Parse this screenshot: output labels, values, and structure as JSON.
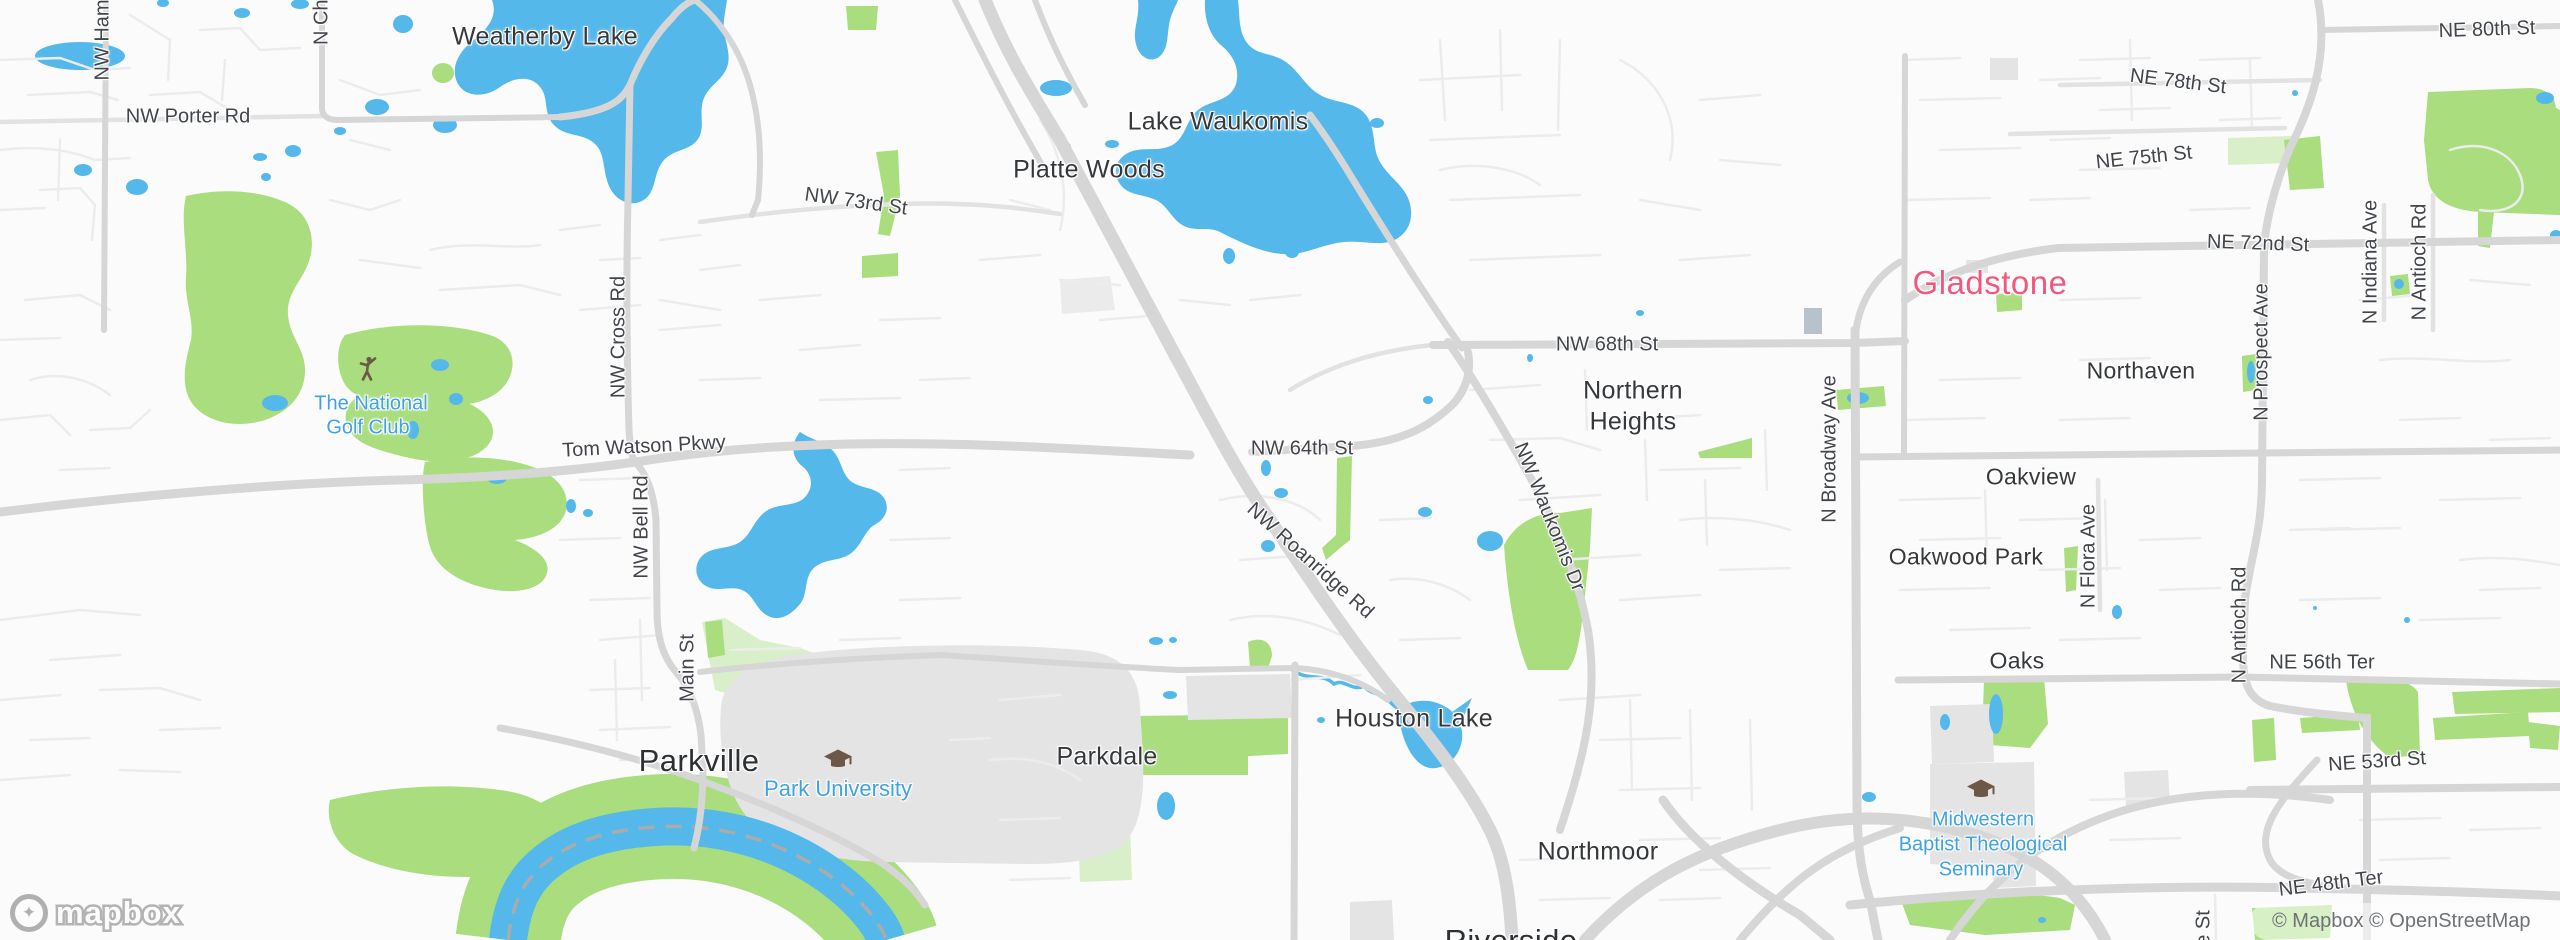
{
  "colors": {
    "water": "#55b8ea",
    "park_green": "#a9dd7e",
    "park_pale": "#d9efc9",
    "building_gray": "#e4e4e4",
    "building_slate": "#b8c2cb",
    "road_major": "#d6d6d6",
    "road_minor": "#ececec",
    "city_label": "#35383b",
    "city_highlight_pink": "#f3577e",
    "poi_blue": "#3fa2e1",
    "poi_icon_brown": "#6d5847"
  },
  "places": {
    "weatherby": "Weatherby Lake",
    "lake_waukomis": "Lake Waukomis",
    "platte_woods": "Platte Woods",
    "gladstone": "Gladstone",
    "northern_heights_1": "Northern",
    "northern_heights_2": "Heights",
    "northaven": "Northaven",
    "oakview": "Oakview",
    "oakwood_park": "Oakwood Park",
    "oaks": "Oaks",
    "houston_lake": "Houston Lake",
    "parkdale": "Parkdale",
    "parkville": "Parkville",
    "northmoor": "Northmoor",
    "riverside": "Riverside"
  },
  "pois": {
    "golf_line1": "The National",
    "golf_line2": "Golf Club",
    "park_university": "Park University",
    "seminary_line1": "Midwestern",
    "seminary_line2": "Baptist Theological",
    "seminary_line3": "Seminary"
  },
  "roads": {
    "nw_porter": "NW Porter Rd",
    "nw_ham": "NW Ham",
    "n_chi": "N Chi",
    "nw_73rd": "NW 73rd St",
    "ne_80th": "NE 80th St",
    "ne_78th": "NE 78th St",
    "ne_75th": "NE 75th St",
    "ne_72nd": "NE 72nd St",
    "nw_68th": "NW 68th St",
    "nw_64th": "NW 64th St",
    "tom_watson": "Tom Watson Pkwy",
    "nw_cross": "NW Cross Rd",
    "nw_bell": "NW Bell Rd",
    "main_st": "Main St",
    "nw_roanridge": "NW Roanridge Rd",
    "nw_waukomis": "NW Waukomis Dr",
    "n_broadway": "N Broadway Ave",
    "n_prospect": "N Prospect Ave",
    "n_indiana": "N Indiana Ave",
    "n_antioch_top": "N Antioch Rd",
    "n_antioch_mid": "N Antioch Rd",
    "n_flora": "N Flora Ave",
    "ne_56th": "NE 56th Ter",
    "ne_53rd": "NE 53rd St",
    "ne_48th": "NE 48th Ter",
    "e_st_partial": "e St"
  },
  "footer": {
    "logo_text": "mapbox",
    "attribution": "© Mapbox © OpenStreetMap"
  }
}
